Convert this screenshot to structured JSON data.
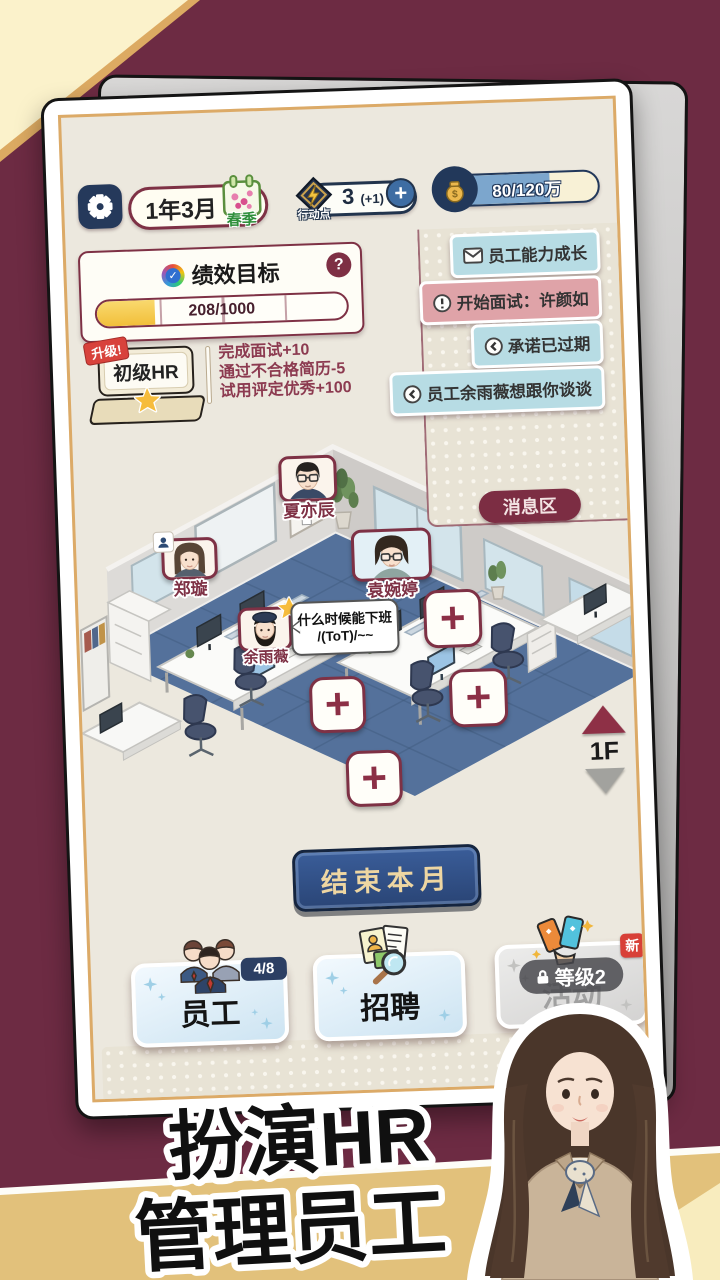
{
  "top_bar": {
    "date": "1年3月",
    "season": "春季",
    "action_points": {
      "label": "行动点",
      "value": "3",
      "bonus": "(+1)",
      "plus_label": "+"
    },
    "money": {
      "value": "80/120万"
    }
  },
  "kpi": {
    "title": "绩效目标",
    "help_label": "?",
    "progress": "208/1000"
  },
  "level": {
    "ribbon": "升级!",
    "name": "初级HR"
  },
  "tasks": [
    "完成面试+10",
    "通过不合格简历-5",
    "试用评定优秀+100"
  ],
  "notifications": [
    {
      "icon": "mail-icon",
      "type": "info",
      "text": "员工能力成长"
    },
    {
      "icon": "alert-icon",
      "type": "urgent",
      "text": "开始面试：许颜如"
    },
    {
      "icon": "back-icon",
      "type": "info",
      "text": "承诺已过期"
    },
    {
      "icon": "back-icon",
      "type": "info",
      "text": "员工余雨薇想跟你谈谈"
    }
  ],
  "message_zone_label": "消息区",
  "office": {
    "employees": [
      {
        "name": "夏亦辰"
      },
      {
        "name": "郑璇"
      },
      {
        "name": "袁婉婷"
      },
      {
        "name": "余雨薇"
      }
    ],
    "speech_bubble": {
      "line1": "什么时候能下班",
      "line2": "/(ToT)/~~"
    },
    "floor": "1F",
    "add_desk": "+"
  },
  "end_month_button": "结束本月",
  "bottom_menu": {
    "staff": {
      "label": "员工",
      "badge": "4/8"
    },
    "recruit": {
      "label": "招聘"
    },
    "activity": {
      "label": "活动",
      "lock": "等级2",
      "new": "新"
    }
  },
  "banner": {
    "line1": "扮演HR",
    "line2": "管理员工"
  },
  "colors": {
    "background_maroon": "#6d2b43",
    "accent_maroon": "#7e3145",
    "navy": "#25395b",
    "gold": "#ecb84d",
    "notif_blue": "#b7dce4",
    "notif_pink": "#dfa3a8",
    "end_button_blue": "#2f4e87",
    "band_tan": "#e2c17b"
  }
}
